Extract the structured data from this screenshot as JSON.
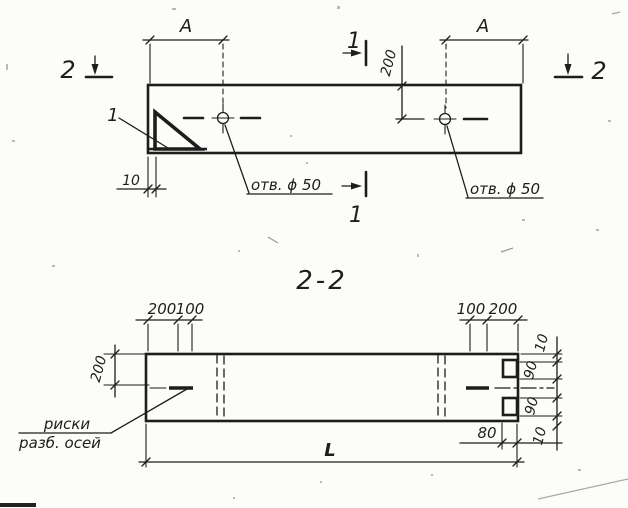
{
  "drawing": {
    "colors": {
      "ink": "#1d1d1d",
      "paper": "#fcfcf9"
    },
    "plan_view": {
      "section_cut_1_top": "1",
      "section_cut_1_bottom": "1",
      "section_cut_2_left": "2",
      "section_cut_2_right": "2",
      "dim_a_left": "A",
      "dim_a_right": "A",
      "dim_hole_offset": "200",
      "dim_end_offset": "10",
      "hole_label_left": "отв. ϕ 50",
      "hole_label_right": "отв. ϕ 50",
      "detail_mark": "1"
    },
    "section_view": {
      "title": "2-2",
      "dims_top_left": [
        "200",
        "100"
      ],
      "dims_top_right": [
        "100",
        "200"
      ],
      "dim_height": "200",
      "dims_right_side": [
        "10",
        "90",
        "90",
        "10"
      ],
      "dim_notch": "80",
      "dim_length": "L",
      "axis_note_line1": "риски",
      "axis_note_line2": "разб. осей"
    }
  }
}
